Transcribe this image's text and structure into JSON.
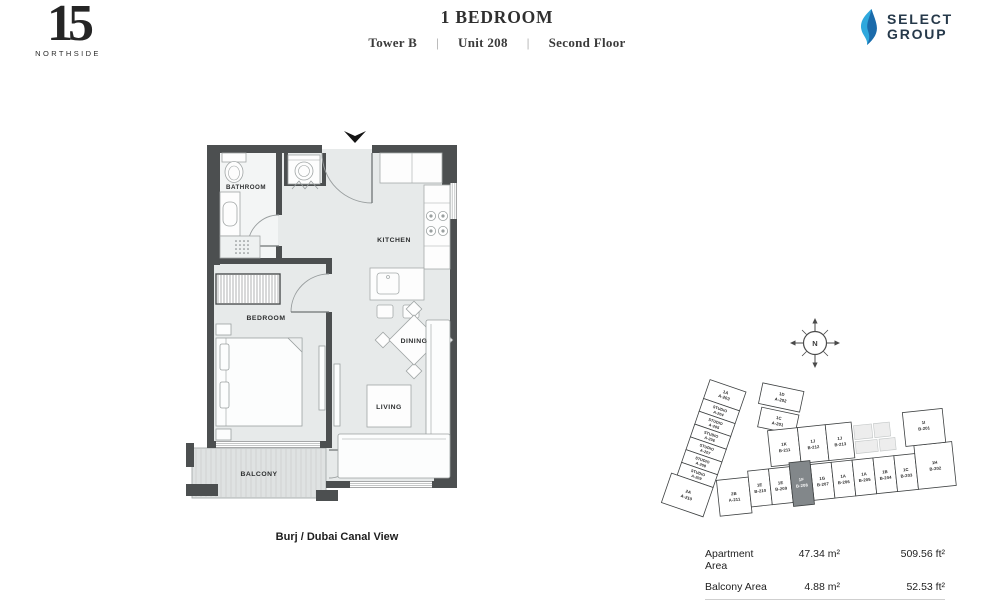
{
  "brand": {
    "number": "15",
    "name": "NORTHSIDE"
  },
  "header": {
    "title": "1 BEDROOM",
    "tower": "Tower B",
    "unit": "Unit 208",
    "floor": "Second Floor",
    "separator": "|"
  },
  "developer": {
    "line1": "SELECT",
    "line2": "GROUP"
  },
  "floorplan": {
    "labels": {
      "bathroom": "BATHROOM",
      "kitchen": "KITCHEN",
      "bedroom": "BEDROOM",
      "dining": "DINING",
      "living": "LIVING",
      "balcony": "BALCONY"
    },
    "view_caption": "Burj / Dubai Canal View"
  },
  "compass": {
    "north": "N"
  },
  "keyplan": {
    "highlighted_unit": "1F B-208",
    "units": [
      {
        "type": "1A",
        "number": "A-203"
      },
      {
        "type": "STUDIO",
        "number": "A-204"
      },
      {
        "type": "STUDIO",
        "number": "A-205"
      },
      {
        "type": "STUDIO",
        "number": "A-206"
      },
      {
        "type": "STUDIO",
        "number": "A-207"
      },
      {
        "type": "STUDIO",
        "number": "A-208"
      },
      {
        "type": "STUDIO",
        "number": "A-209"
      },
      {
        "type": "2A",
        "number": "A-210"
      },
      {
        "type": "2B",
        "number": "A-211"
      },
      {
        "type": "1D",
        "number": "A-202"
      },
      {
        "type": "1C",
        "number": "A-201"
      },
      {
        "type": "1K",
        "number": "B-211"
      },
      {
        "type": "1J",
        "number": "B-212"
      },
      {
        "type": "1J",
        "number": "B-213"
      },
      {
        "type": "1I",
        "number": "B-201"
      },
      {
        "type": "1E",
        "number": "B-210"
      },
      {
        "type": "1E",
        "number": "B-209"
      },
      {
        "type": "1F",
        "number": "B-208",
        "highlighted": true
      },
      {
        "type": "1G",
        "number": "B-207"
      },
      {
        "type": "1A",
        "number": "B-206"
      },
      {
        "type": "1A",
        "number": "B-205"
      },
      {
        "type": "1B",
        "number": "B-204"
      },
      {
        "type": "1C",
        "number": "B-203"
      },
      {
        "type": "1H",
        "number": "B-202"
      }
    ]
  },
  "areas": {
    "rows": [
      {
        "label": "Apartment Area",
        "sqm": "47.34 m²",
        "sqft": "509.56 ft²"
      },
      {
        "label": "Balcony Area",
        "sqm": "4.88 m²",
        "sqft": "52.53 ft²"
      }
    ],
    "total": {
      "label": "Total Area",
      "sqm": "52.22 m²",
      "sqft": "562.09 ft²"
    }
  },
  "colors": {
    "wall": "#4c4f50",
    "floor": "#e7eaea",
    "keyplan_highlight": "#82878a",
    "brand_blue": "#2fa8dd",
    "logo_navy": "#26394a"
  }
}
